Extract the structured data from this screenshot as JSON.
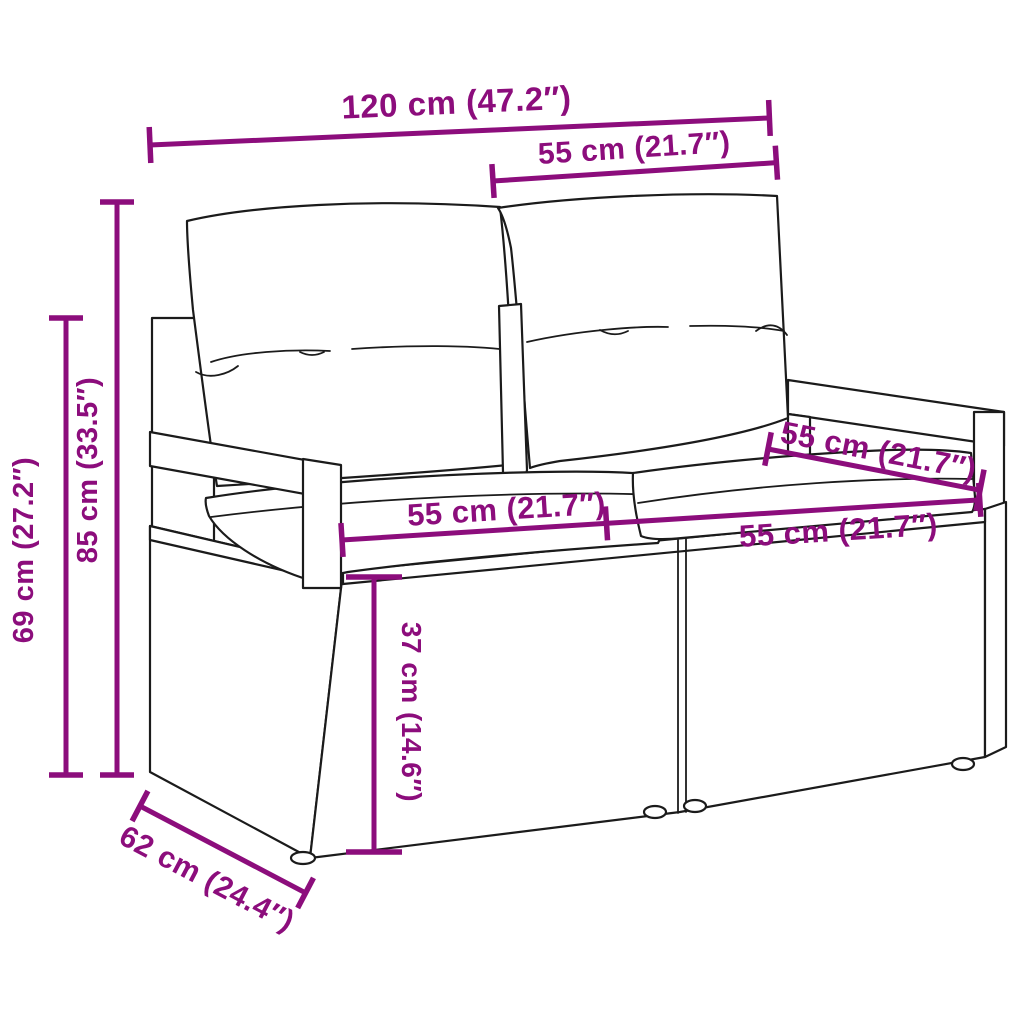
{
  "diagram": {
    "subject": "poly-rattan two-seater garden sofa with cushions - dimension drawing",
    "background": "#ffffff",
    "accent_color": "#8C0D7C",
    "line_art_color": "#1b1b1b"
  },
  "dimensions": {
    "overall_width": "120 cm (47.2″)",
    "back_cushion_width": "55 cm (21.7″)",
    "overall_height": "85 cm (33.5″)",
    "frame_height": "69 cm (27.2″)",
    "seat_depth": "55 cm (21.7″)",
    "seat_width_left": "55 cm (21.7″)",
    "seat_width_right": "55 cm (21.7″)",
    "seat_height": "37 cm (14.6″)",
    "overall_depth": "62 cm (24.4″)"
  }
}
